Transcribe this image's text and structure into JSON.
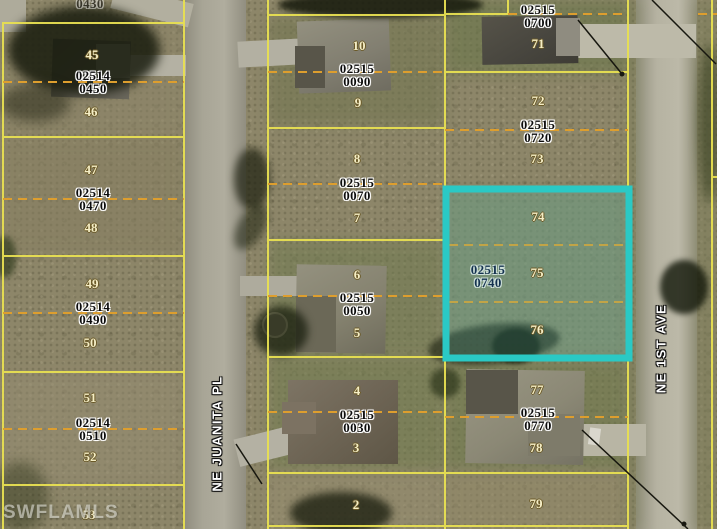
{
  "watermark": "SWFLAMLS",
  "streets": [
    {
      "name": "NE JUANITA PL"
    },
    {
      "name": "NE 1ST AVE"
    }
  ],
  "colors": {
    "parcel_boundary_yellow": "#e8e052",
    "lot_line_orange": "#dd9e2e",
    "highlight_cyan": "#2ac9c5",
    "parcel_label_text": "#0c0c0c",
    "highlight_label_text": "#14324f",
    "lot_number_text": "#f5eec6"
  },
  "columns": {
    "left": {
      "partial_top_label": "0430",
      "parcels": [
        {
          "id": "02514 0450",
          "lots": [
            "45",
            "46"
          ]
        },
        {
          "id": "02514 0470",
          "lots": [
            "47",
            "48"
          ]
        },
        {
          "id": "02514 0490",
          "lots": [
            "49",
            "50"
          ]
        },
        {
          "id": "02514 0510",
          "lots": [
            "51",
            "52"
          ]
        }
      ],
      "partial_bottom_lot": "53"
    },
    "middle": {
      "parcels": [
        {
          "id": "02515 0090",
          "lots": [
            "10",
            "9"
          ]
        },
        {
          "id": "02515 0070",
          "lots": [
            "8",
            "7"
          ]
        },
        {
          "id": "02515 0050",
          "lots": [
            "6",
            "5"
          ]
        },
        {
          "id": "02515 0030",
          "lots": [
            "4",
            "3"
          ]
        }
      ],
      "partial_bottom_lot": "2"
    },
    "right": {
      "parcels": [
        {
          "id": "02515 0700",
          "lots": [
            "71"
          ]
        },
        {
          "id": "02515 0720",
          "lots": [
            "72",
            "73"
          ]
        },
        {
          "id": "02515 0740",
          "lots": [
            "74",
            "75",
            "76"
          ],
          "highlighted": true
        },
        {
          "id": "02515 0770",
          "lots": [
            "77",
            "78"
          ]
        }
      ],
      "partial_bottom_lot": "79"
    }
  }
}
